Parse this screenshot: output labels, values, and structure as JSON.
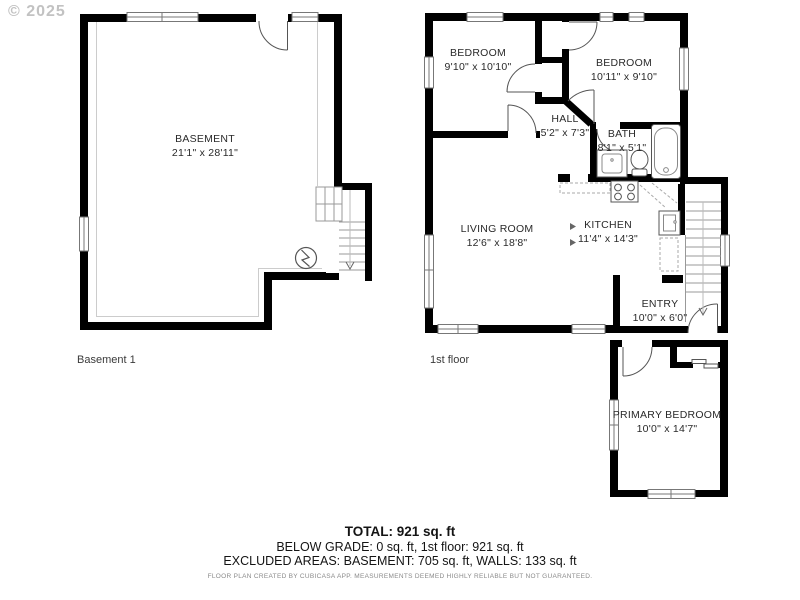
{
  "watermark": "© 2025",
  "colors": {
    "wall": "#000000",
    "thin_line": "#999999",
    "text": "#2a2a2a",
    "watermark": "#c2c2c2",
    "disclaimer": "#8a8a8a"
  },
  "floors": {
    "basement": {
      "label": "Basement 1",
      "rooms": {
        "basement": {
          "name": "BASEMENT",
          "dims": "21'1\" x 28'11\""
        }
      }
    },
    "first": {
      "label": "1st floor",
      "rooms": {
        "bedroom1": {
          "name": "BEDROOM",
          "dims": "9'10\" x 10'10\""
        },
        "bedroom2": {
          "name": "BEDROOM",
          "dims": "10'11\" x 9'10\""
        },
        "hall": {
          "name": "HALL",
          "dims": "5'2\" x 7'3\""
        },
        "bath": {
          "name": "BATH",
          "dims": "8'1\" x 5'1\""
        },
        "living": {
          "name": "LIVING ROOM",
          "dims": "12'6\" x 18'8\""
        },
        "kitchen": {
          "name": "KITCHEN",
          "dims": "11'4\" x 14'3\""
        },
        "entry": {
          "name": "ENTRY",
          "dims": "10'0\" x 6'0\""
        },
        "primary": {
          "name": "PRIMARY BEDROOM",
          "dims": "10'0\" x 14'7\""
        }
      }
    }
  },
  "footer": {
    "total": "TOTAL: 921 sq. ft",
    "line2": "BELOW GRADE: 0 sq. ft, 1st floor: 921 sq. ft",
    "line3": "EXCLUDED AREAS: BASEMENT: 705 sq. ft, WALLS: 133 sq. ft",
    "disclaimer": "FLOOR PLAN CREATED BY CUBICASA APP. MEASUREMENTS DEEMED HIGHLY RELIABLE BUT NOT GUARANTEED."
  }
}
